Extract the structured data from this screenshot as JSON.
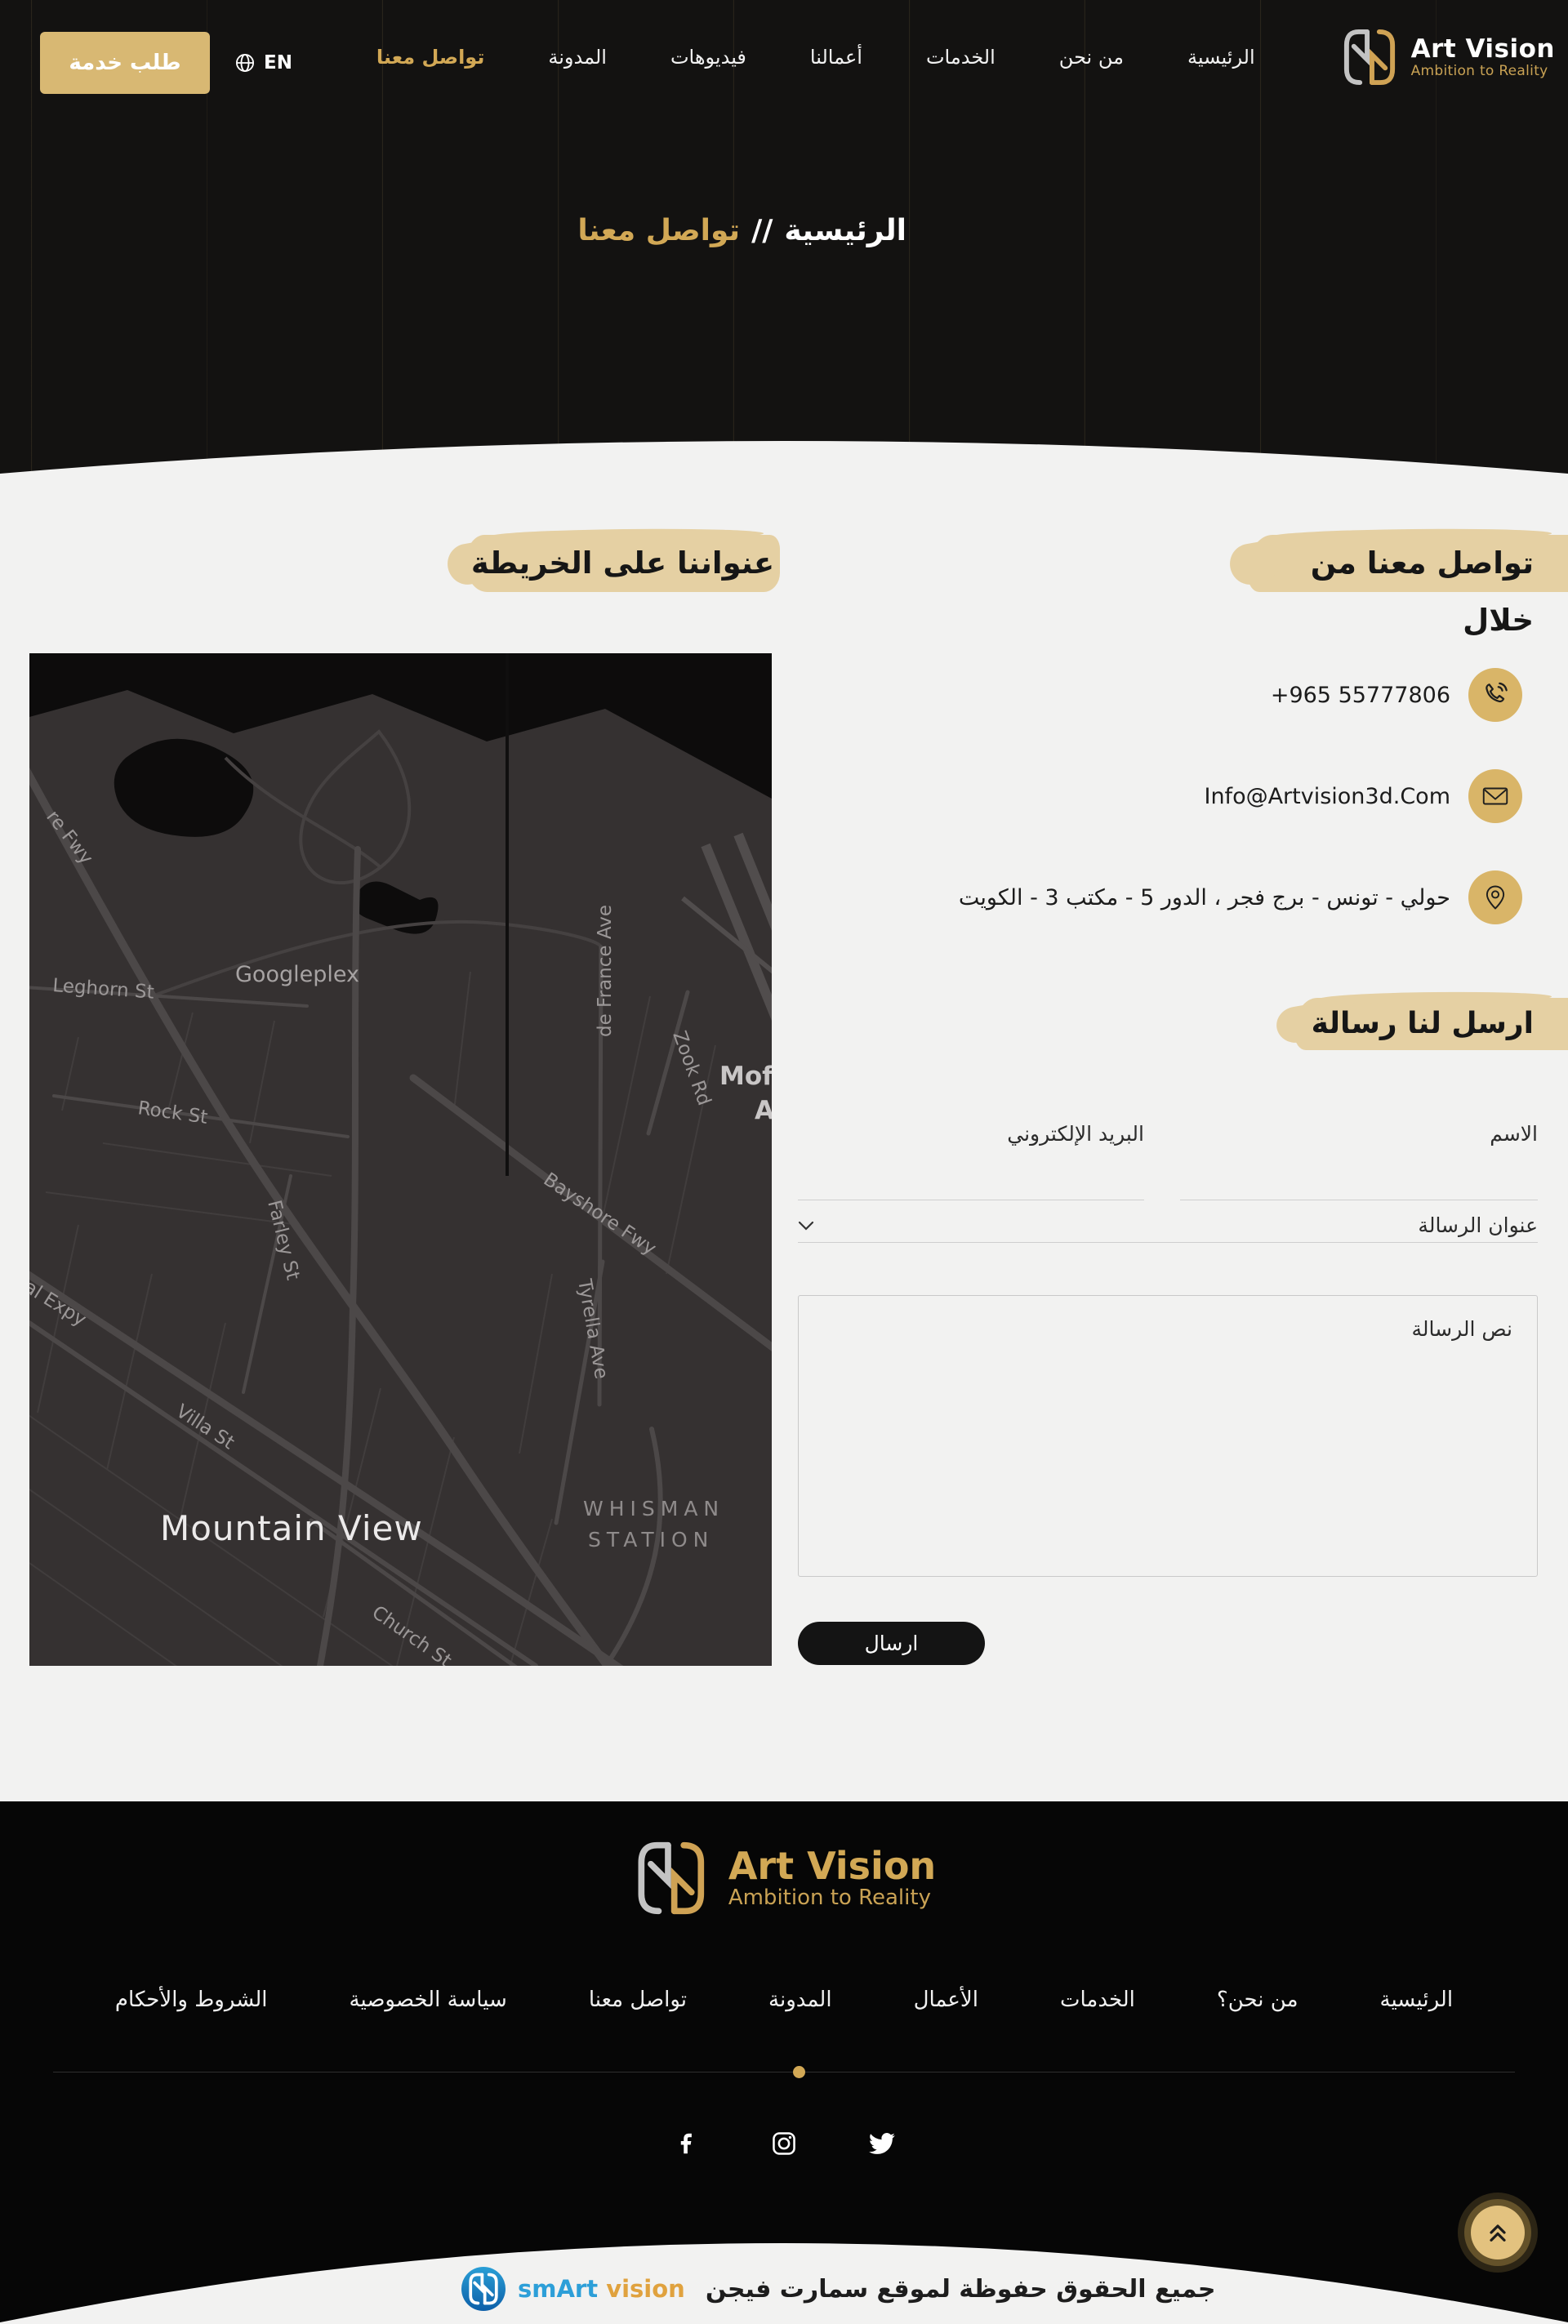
{
  "brand": {
    "name": "Art Vision",
    "tagline": "Ambition to Reality"
  },
  "header": {
    "menu": [
      {
        "label": "الرئيسية"
      },
      {
        "label": "من نحن"
      },
      {
        "label": "الخدمات"
      },
      {
        "label": "أعمالنا"
      },
      {
        "label": "فيديوهات"
      },
      {
        "label": "المدونة"
      },
      {
        "label": "تواصل معنا"
      }
    ],
    "language": "EN",
    "cta": "طلب خدمة",
    "breadcrumb": {
      "root": "الرئيسية",
      "separator": "//",
      "current": "تواصل معنا"
    }
  },
  "contact": {
    "heading": "تواصل معنا من خلال",
    "phone": "+965 55777806",
    "email": "Info@Artvision3d.Com",
    "address": "حولي - تونس - برج فجر ، الدور 5 - مكتب 3 - الكويت"
  },
  "map_section": {
    "heading": "عنواننا على الخريطة",
    "labels": {
      "fwy": "re Fwy",
      "leghorn": "Leghorn St",
      "googleplex": "Googleplex",
      "rock": "Rock St",
      "defrance": "de France Ave",
      "zook": "Zook Rd",
      "moffett": "Moffe",
      "moffett2": "A",
      "bayshore": "Bayshore Fwy",
      "farley": "Farley St",
      "tyrella": "Tyrella Ave",
      "expy": "al Expy",
      "villa": "Villa St",
      "church": "Church St",
      "city": "Mountain View",
      "whisman1": "WHISMAN",
      "whisman2": "STATION"
    }
  },
  "form": {
    "heading": "ارسل لنا رسالة",
    "name_placeholder": "الاسم",
    "email_placeholder": "البريد الإلكتروني",
    "subject_placeholder": "عنوان الرسالة",
    "message_placeholder": "نص الرسالة",
    "submit": "ارسال"
  },
  "footer": {
    "menu": [
      {
        "label": "الرئيسية"
      },
      {
        "label": "من نحن؟"
      },
      {
        "label": "الخدمات"
      },
      {
        "label": "الأعمال"
      },
      {
        "label": "المدونة"
      },
      {
        "label": "تواصل معنا"
      },
      {
        "label": "سياسة الخصوصية"
      },
      {
        "label": "الشروط والأحكام"
      }
    ],
    "socials": [
      "facebook-icon",
      "instagram-icon",
      "twitter-icon"
    ],
    "copyright": "جميع الحقوق حفوظة لموقع سمارت فيجن",
    "credit": {
      "smart": "smArt",
      "vision": "vision"
    }
  },
  "colors": {
    "gold": "#d2a855",
    "gold_button": "#d8b873",
    "icon_circle": "#d9b568",
    "brush": "#e5d0a3",
    "dark_bg": "#131211",
    "light_bg": "#f2f2f1",
    "credit_blue": "#2d9fd8",
    "credit_orange": "#e0a23e"
  }
}
